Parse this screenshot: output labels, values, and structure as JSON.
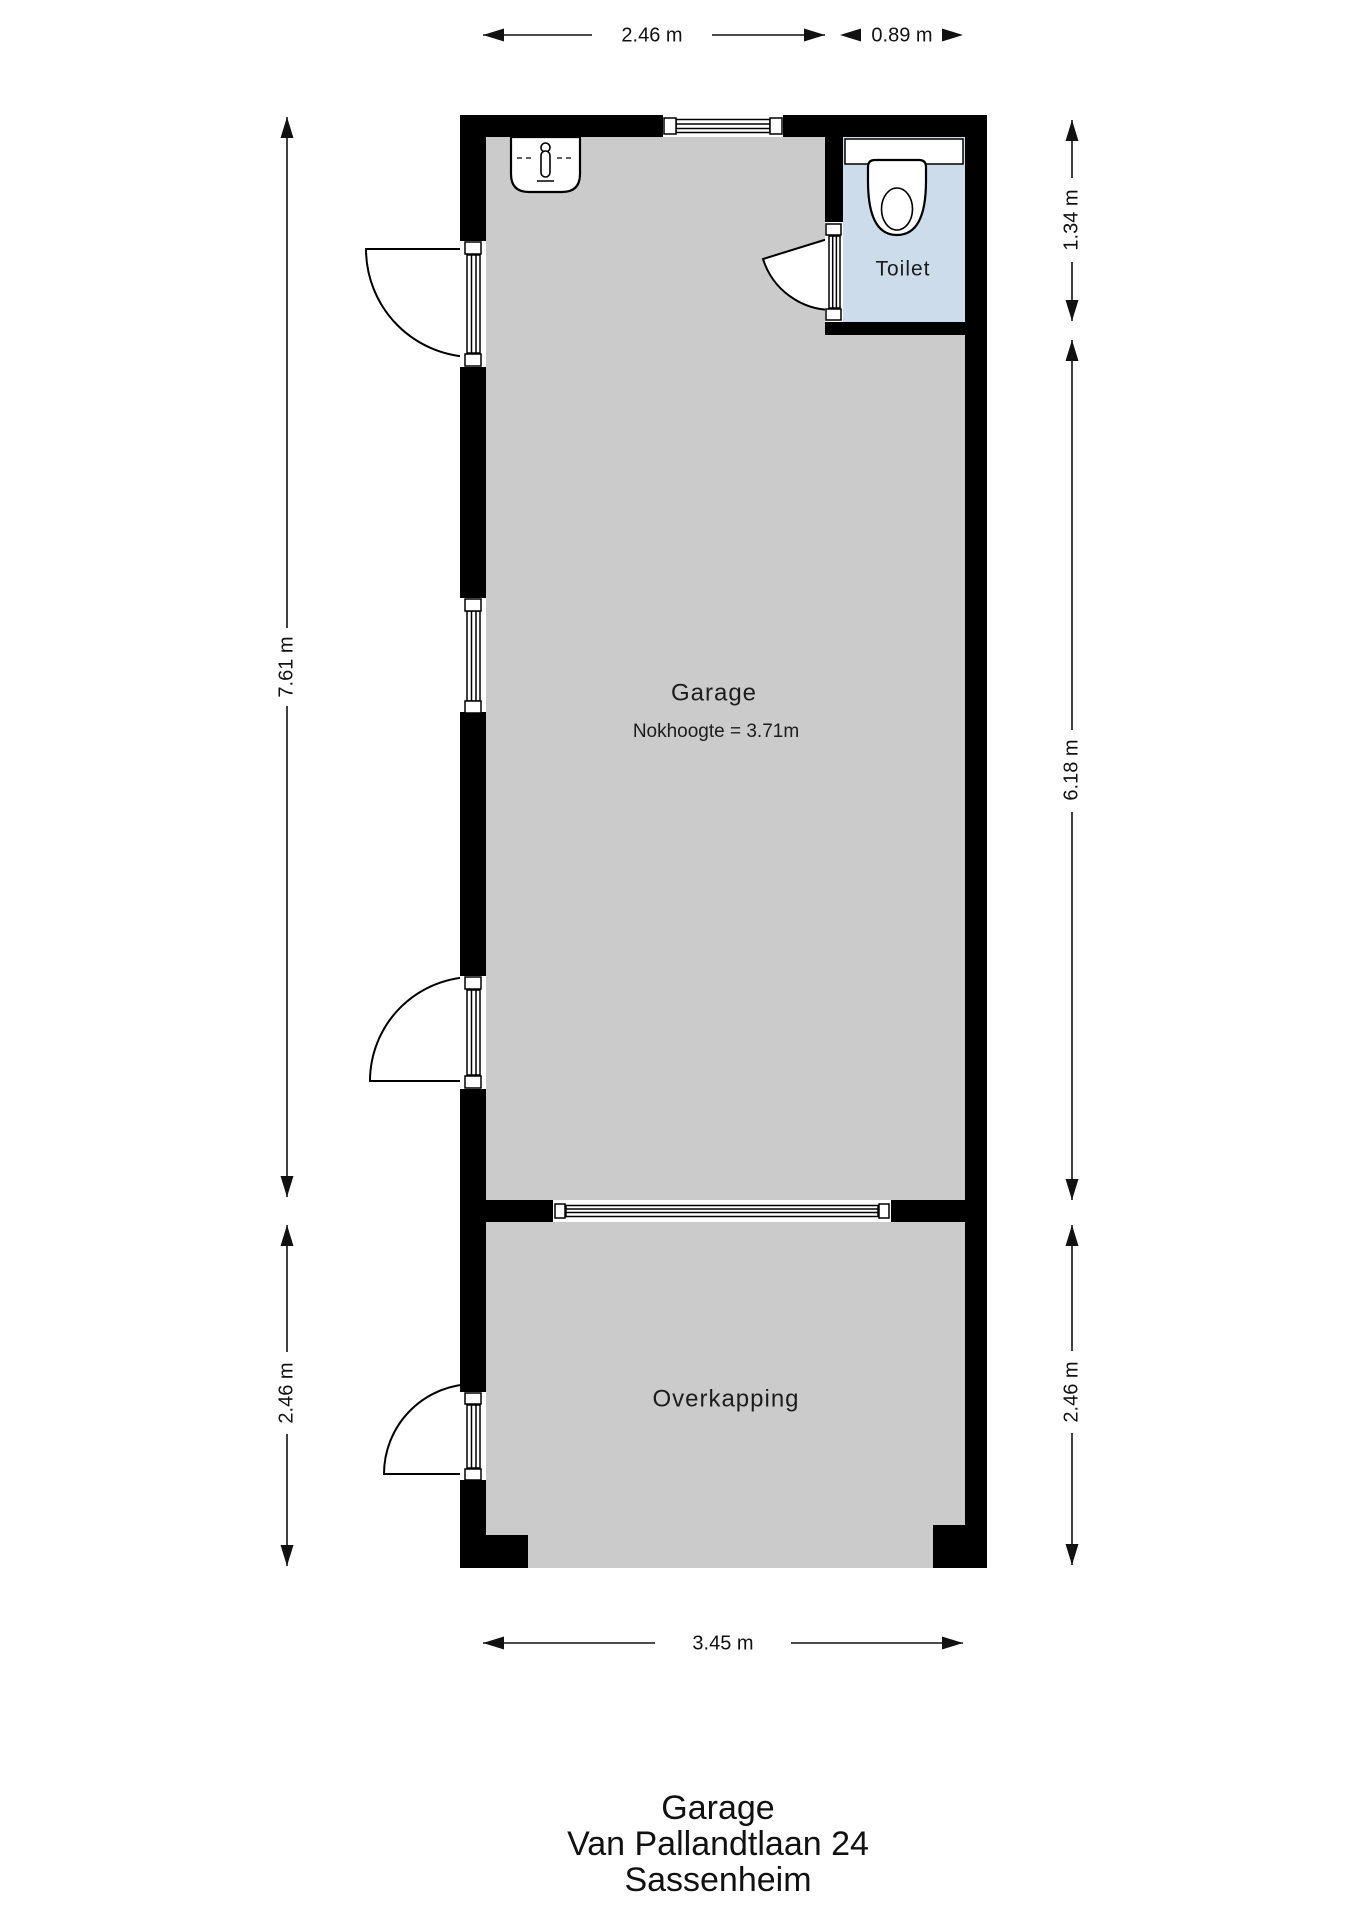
{
  "rooms": {
    "garage": {
      "label": "Garage",
      "sublabel": "Nokhoogte = 3.71m"
    },
    "toilet": {
      "label": "Toilet"
    },
    "overkapping": {
      "label": "Overkapping"
    }
  },
  "dimensions": {
    "top_garage_width": "2.46 m",
    "top_toilet_width": "0.89 m",
    "left_garage_height": "7.61 m",
    "left_overkapping_height": "2.46 m",
    "right_toilet_height": "1.34 m",
    "right_garage_height": "6.18 m",
    "right_overkapping_height": "2.46 m",
    "bottom_width": "3.45 m"
  },
  "footer": {
    "line1": "Garage",
    "line2": "Van Pallandtlaan 24",
    "line3": "Sassenheim"
  },
  "colors": {
    "wall": "#000000",
    "floor": "#cbcbcb",
    "toilet_floor": "#cddcea",
    "background": "#ffffff",
    "line": "#111111"
  }
}
